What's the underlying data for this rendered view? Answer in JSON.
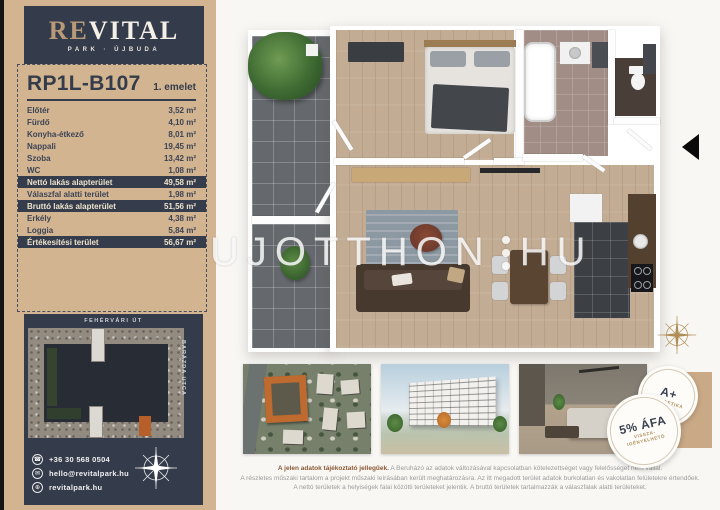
{
  "brand": {
    "logo_first": "RE",
    "logo_rest": "VITAL",
    "tagline": "PARK · ÚJBUDA"
  },
  "unit": {
    "code": "RP1L-B107",
    "floor_label": "1. emelet"
  },
  "area_table": {
    "rows": [
      {
        "label": "Előtér",
        "value": "3,52 m²"
      },
      {
        "label": "Fürdő",
        "value": "4,10 m²"
      },
      {
        "label": "Konyha-étkező",
        "value": "8,01 m²"
      },
      {
        "label": "Nappali",
        "value": "19,45 m²"
      },
      {
        "label": "Szoba",
        "value": "13,42 m²"
      },
      {
        "label": "WC",
        "value": "1,08 m²"
      },
      {
        "label": "Nettó lakás alapterület",
        "value": "49,58 m²",
        "highlight": true
      },
      {
        "label": "Válaszfal alatti terület",
        "value": "1,98 m²"
      },
      {
        "label": "Bruttó lakás alapterület",
        "value": "51,56 m²",
        "highlight": true
      },
      {
        "label": "Erkély",
        "value": "4,38 m²"
      },
      {
        "label": "Loggia",
        "value": "5,84 m²"
      },
      {
        "label": "Értékesítési terület",
        "value": "56,67 m²",
        "highlight": true
      }
    ]
  },
  "site_map": {
    "street_top": "FEHÉRVÁRI ÚT",
    "street_side": "BARÁZDA UTCA"
  },
  "contact": {
    "items": [
      {
        "icon": "phone-icon",
        "glyph": "☎",
        "label": "+36 30 568 0504"
      },
      {
        "icon": "mail-icon",
        "glyph": "✉",
        "label": "hello@revitalpark.hu"
      },
      {
        "icon": "globe-icon",
        "glyph": "⊕",
        "label": "revitalpark.hu"
      }
    ]
  },
  "floor_plan": {
    "watermark_left": "UJOTTHON",
    "watermark_right": "HU"
  },
  "badges": {
    "energy": {
      "title": "A+",
      "subtitle": "ENERGETIKA"
    },
    "vat": {
      "title": "5% ÁFA",
      "subtitle_line1": "VISSZA-",
      "subtitle_line2": "IGÉNYELHETŐ"
    }
  },
  "disclaimer": {
    "line1_bold": "A jelen adatok tájékoztató jellegűek.",
    "line1_rest": " A Beruházó az adatok változásával kapcsolatban kötelezettséget vagy felelősséget nem vállal.",
    "line2": "A részletes műszaki tartalom a projekt műszaki leírásában került meghatározásra. Az itt megadott terület adatok burkolatlan és vakolatlan felületekre értendőek.",
    "line3": "A nettó területek a helyiségek falai közötti területeket jelentik. A bruttó területek tartalmazzák a válaszfalak alatti területeket."
  },
  "colors": {
    "brand_dark": "#343b4a",
    "brand_tan": "#d2b491",
    "accent_orange": "#b65f2a",
    "gold": "#b08d57"
  }
}
